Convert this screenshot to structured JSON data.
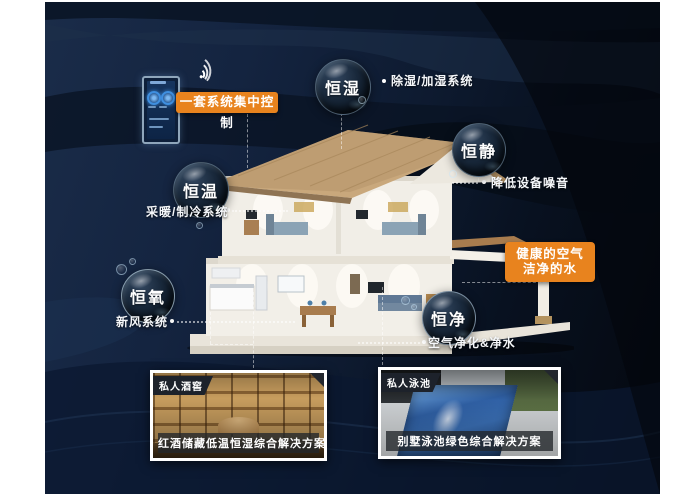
{
  "bubbles": [
    {
      "id": "hengshi",
      "label": "恒湿",
      "desc": "除湿/加湿系统"
    },
    {
      "id": "hengjing",
      "label": "恒静",
      "desc": "降低设备噪音"
    },
    {
      "id": "hengwen",
      "label": "恒温",
      "desc": "采暖/制冷系统"
    },
    {
      "id": "hengyang",
      "label": "恒氧",
      "desc": "新风系统"
    },
    {
      "id": "hengjing2",
      "label": "恒净",
      "desc": "空气净化&净水"
    }
  ],
  "callouts": {
    "central_control": "一套系统集中控制",
    "healthy_line1": "健康的空气",
    "healthy_line2": "洁净的水"
  },
  "photos": [
    {
      "badge": "私人酒窖",
      "caption": "红酒储藏低温恒湿综合解决方案"
    },
    {
      "badge": "私人泳池",
      "caption": "别墅泳池绿色综合解决方案"
    }
  ],
  "icons": [
    {
      "name": "wifi-icon",
      "meaning": "wireless control signal"
    },
    {
      "name": "smart-panel-icon",
      "meaning": "central control touch panel"
    }
  ],
  "colors": {
    "accent_orange": "#e8831e",
    "background_navy": "#142440",
    "background_dark": "#04080f",
    "roof_tan": "#c9a87c",
    "pool_blue": "#2f5fa3"
  }
}
